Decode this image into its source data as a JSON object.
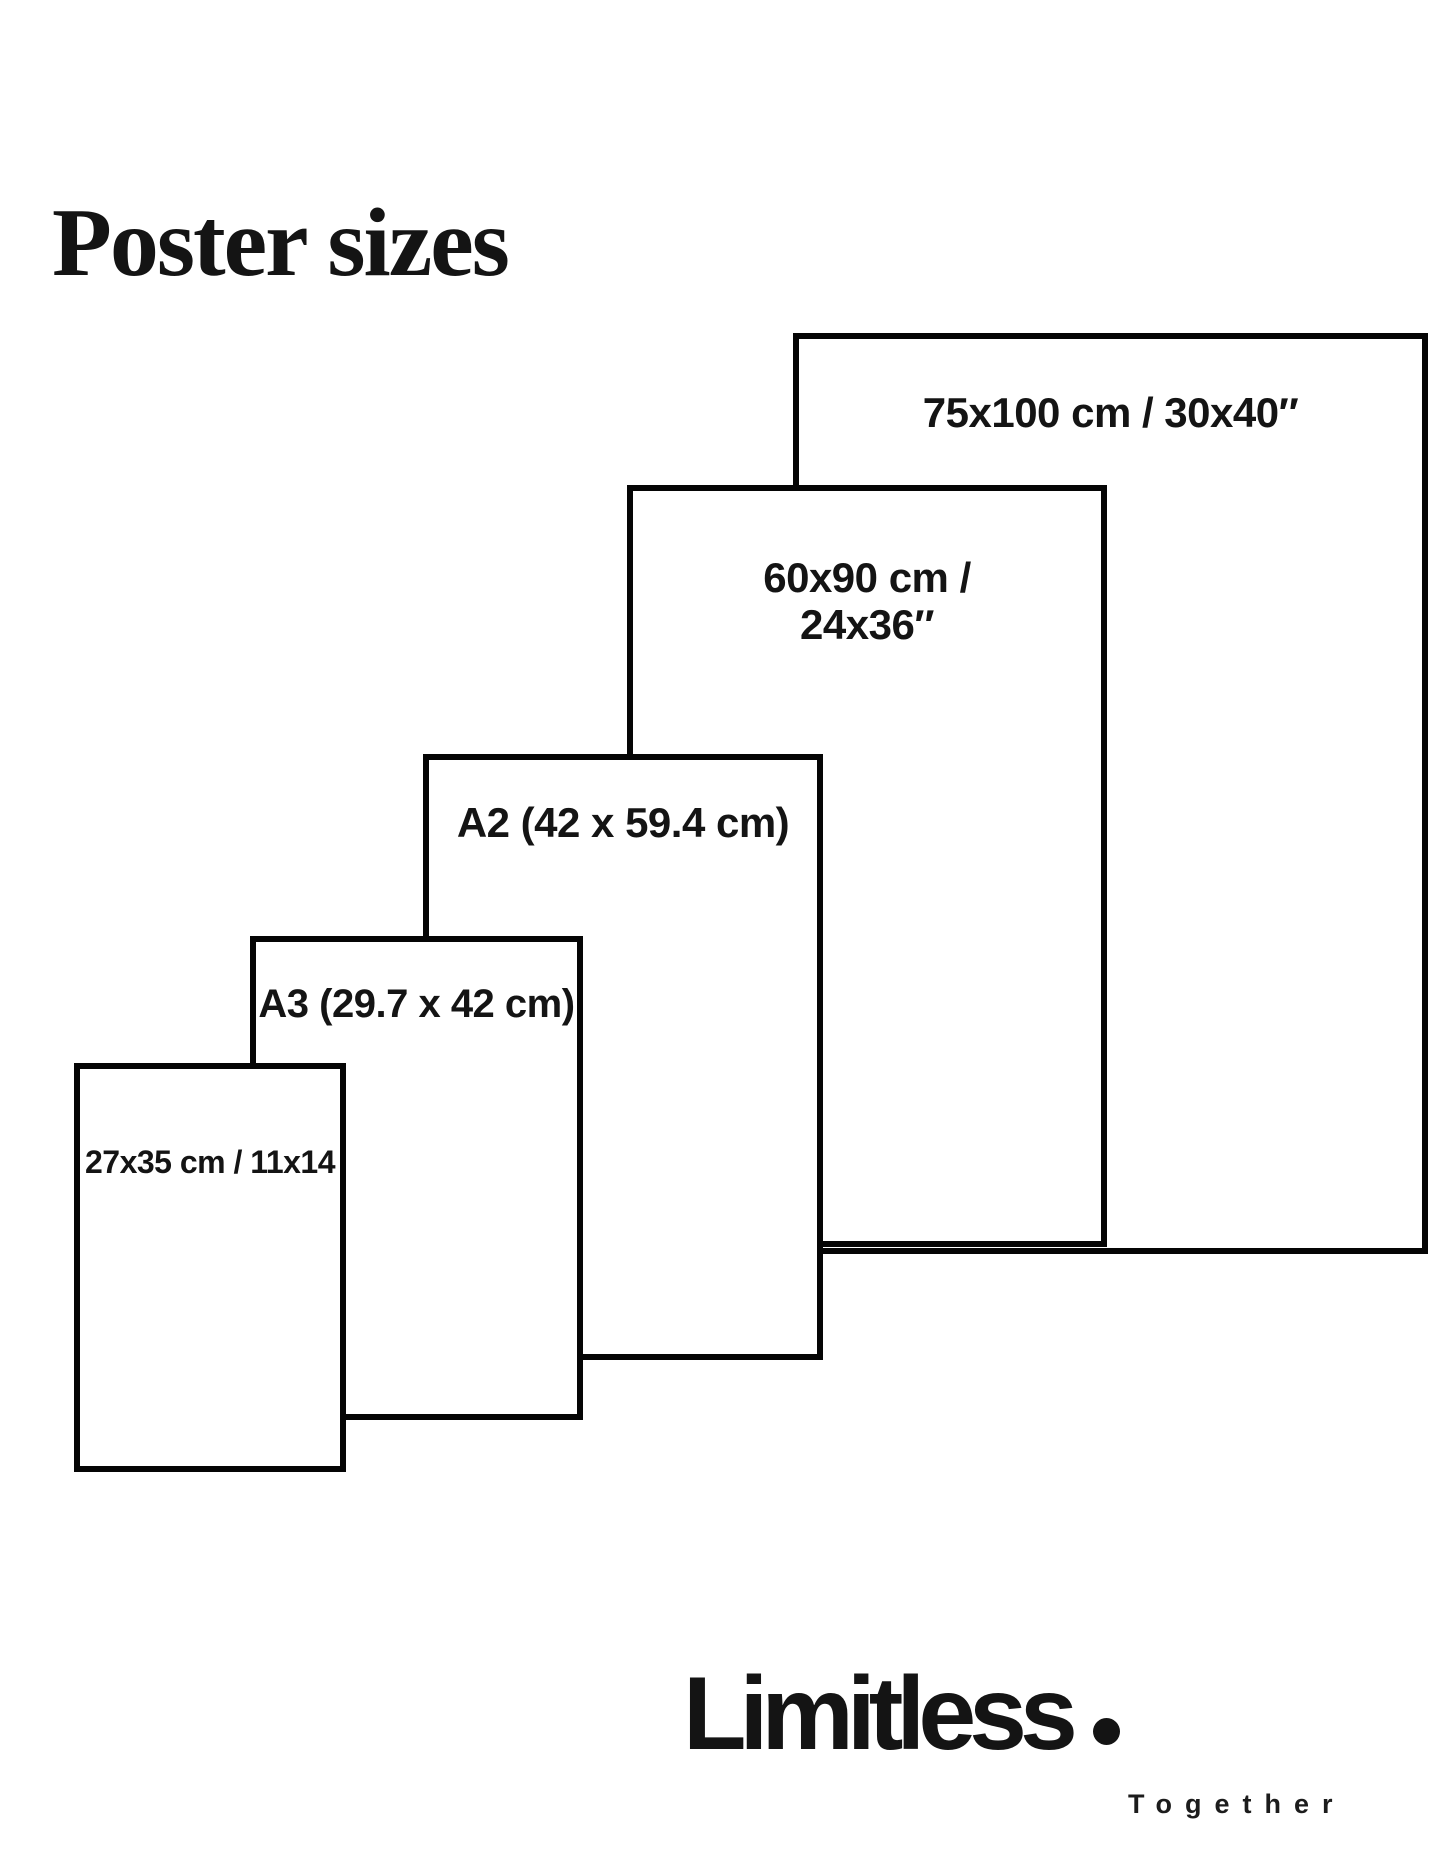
{
  "title": "Poster sizes",
  "colors": {
    "background": "#ffffff",
    "ink": "#141414",
    "line": "#050505"
  },
  "diagram": {
    "description": "Nested rectangles comparing five poster sizes, smallest in front at lower-left, largest behind at upper-right",
    "posters": [
      {
        "id": "75x100",
        "label": "75x100 cm / 30x40″",
        "label_lines": [
          "75x100 cm / 30x40″"
        ],
        "x": 793,
        "y": 333,
        "w": 635,
        "h": 921,
        "label_top": 50,
        "label_size": 42
      },
      {
        "id": "60x90",
        "label": "60x90 cm / 24x36″",
        "label_lines": [
          "60x90 cm /",
          "24x36″"
        ],
        "x": 627,
        "y": 485,
        "w": 480,
        "h": 762,
        "label_top": 63,
        "label_size": 42
      },
      {
        "id": "a2",
        "label": "A2 (42 x 59.4 cm)",
        "label_lines": [
          "A2 (42 x 59.4 cm)"
        ],
        "x": 423,
        "y": 754,
        "w": 400,
        "h": 606,
        "label_top": 39,
        "label_size": 42
      },
      {
        "id": "a3",
        "label": "A3 (29.7 x 42 cm)",
        "label_lines": [
          "A3 (29.7 x 42 cm)"
        ],
        "x": 250,
        "y": 936,
        "w": 333,
        "h": 484,
        "label_top": 40,
        "label_size": 40
      },
      {
        "id": "27x35",
        "label": "27x35 cm / 11x14",
        "label_lines": [
          "27x35 cm / 11x14"
        ],
        "x": 74,
        "y": 1063,
        "w": 272,
        "h": 409,
        "label_top": 76,
        "label_size": 32
      }
    ]
  },
  "footer": {
    "brand": "Limitless",
    "brand_dot": ".",
    "tagline": "Together"
  }
}
